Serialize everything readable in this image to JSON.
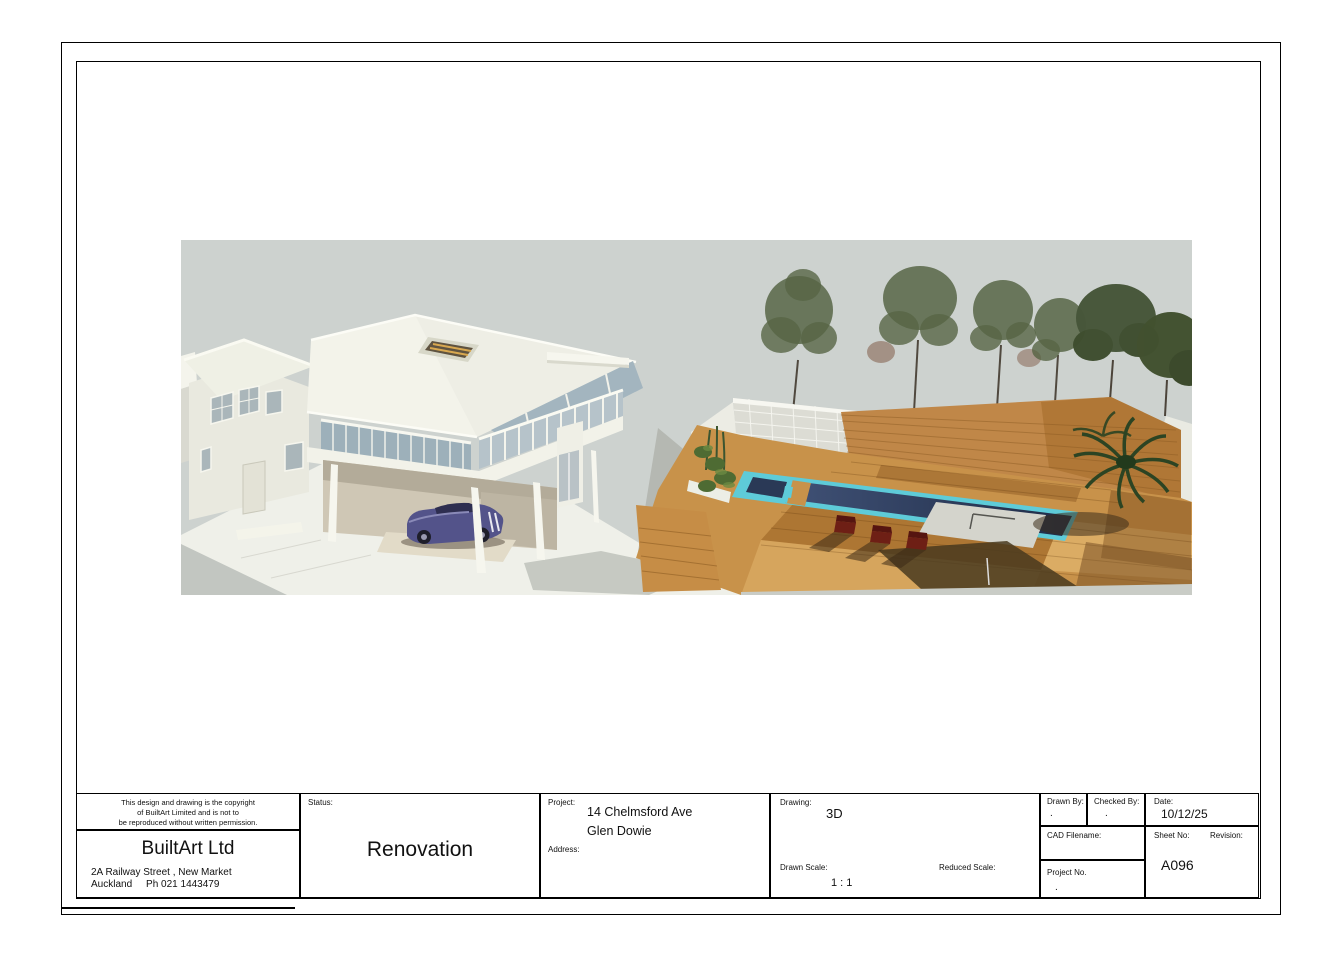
{
  "title_block": {
    "copyright_lines": [
      "This design and drawing is the copyright",
      "of BuiltArt Limited and is not to",
      "be reproduced without written permission."
    ],
    "company": {
      "name": "BuiltArt Ltd",
      "address_line1": "2A Railway Street , New Market",
      "address_line2": "Auckland     Ph 021 1443479"
    },
    "status": {
      "label": "Status:",
      "value": "Renovation"
    },
    "project": {
      "label": "Project:",
      "value_line1": "14 Chelmsford Ave",
      "value_line2": "Glen Dowie",
      "address_label": "Address:",
      "address_value": ""
    },
    "drawing": {
      "label": "Drawing:",
      "value": "3D",
      "drawn_scale_label": "Drawn Scale:",
      "drawn_scale_value": "1 : 1",
      "reduced_scale_label": "Reduced Scale:",
      "reduced_scale_value": ""
    },
    "info": {
      "drawn_by_label": "Drawn By:",
      "drawn_by_value": ".",
      "checked_by_label": "Checked By:",
      "checked_by_value": ".",
      "date_label": "Date:",
      "date_value": "10/12/25",
      "cad_filename_label": "CAD Filename:",
      "cad_filename_value": "",
      "sheet_no_label": "Sheet No:",
      "sheet_no_value": "A096",
      "revision_label": "Revision:",
      "revision_value": "",
      "project_no_label": "Project No.",
      "project_no_value": "."
    }
  },
  "render_image": {
    "description": "3D rendering of a renovated two-storey house with carport and classic car, timber pool deck with swimming pool and spa, timber slat fence, lattice screen, pine trees and palm",
    "colors": {
      "sky": "#cdd2cf",
      "wall": "#efefe6",
      "roof": "#f3f3ea",
      "glass": "#9db0ba",
      "deck_light": "#d9a75f",
      "deck_dark": "#b17434",
      "fence_wood": "#c08748",
      "pool_water": "#273450",
      "pool_edge": "#5ecbd8",
      "tree_green": "#51603f",
      "palm_green": "#2c4423",
      "car_body": "#53538a",
      "chair_red": "#6e1f15"
    }
  }
}
